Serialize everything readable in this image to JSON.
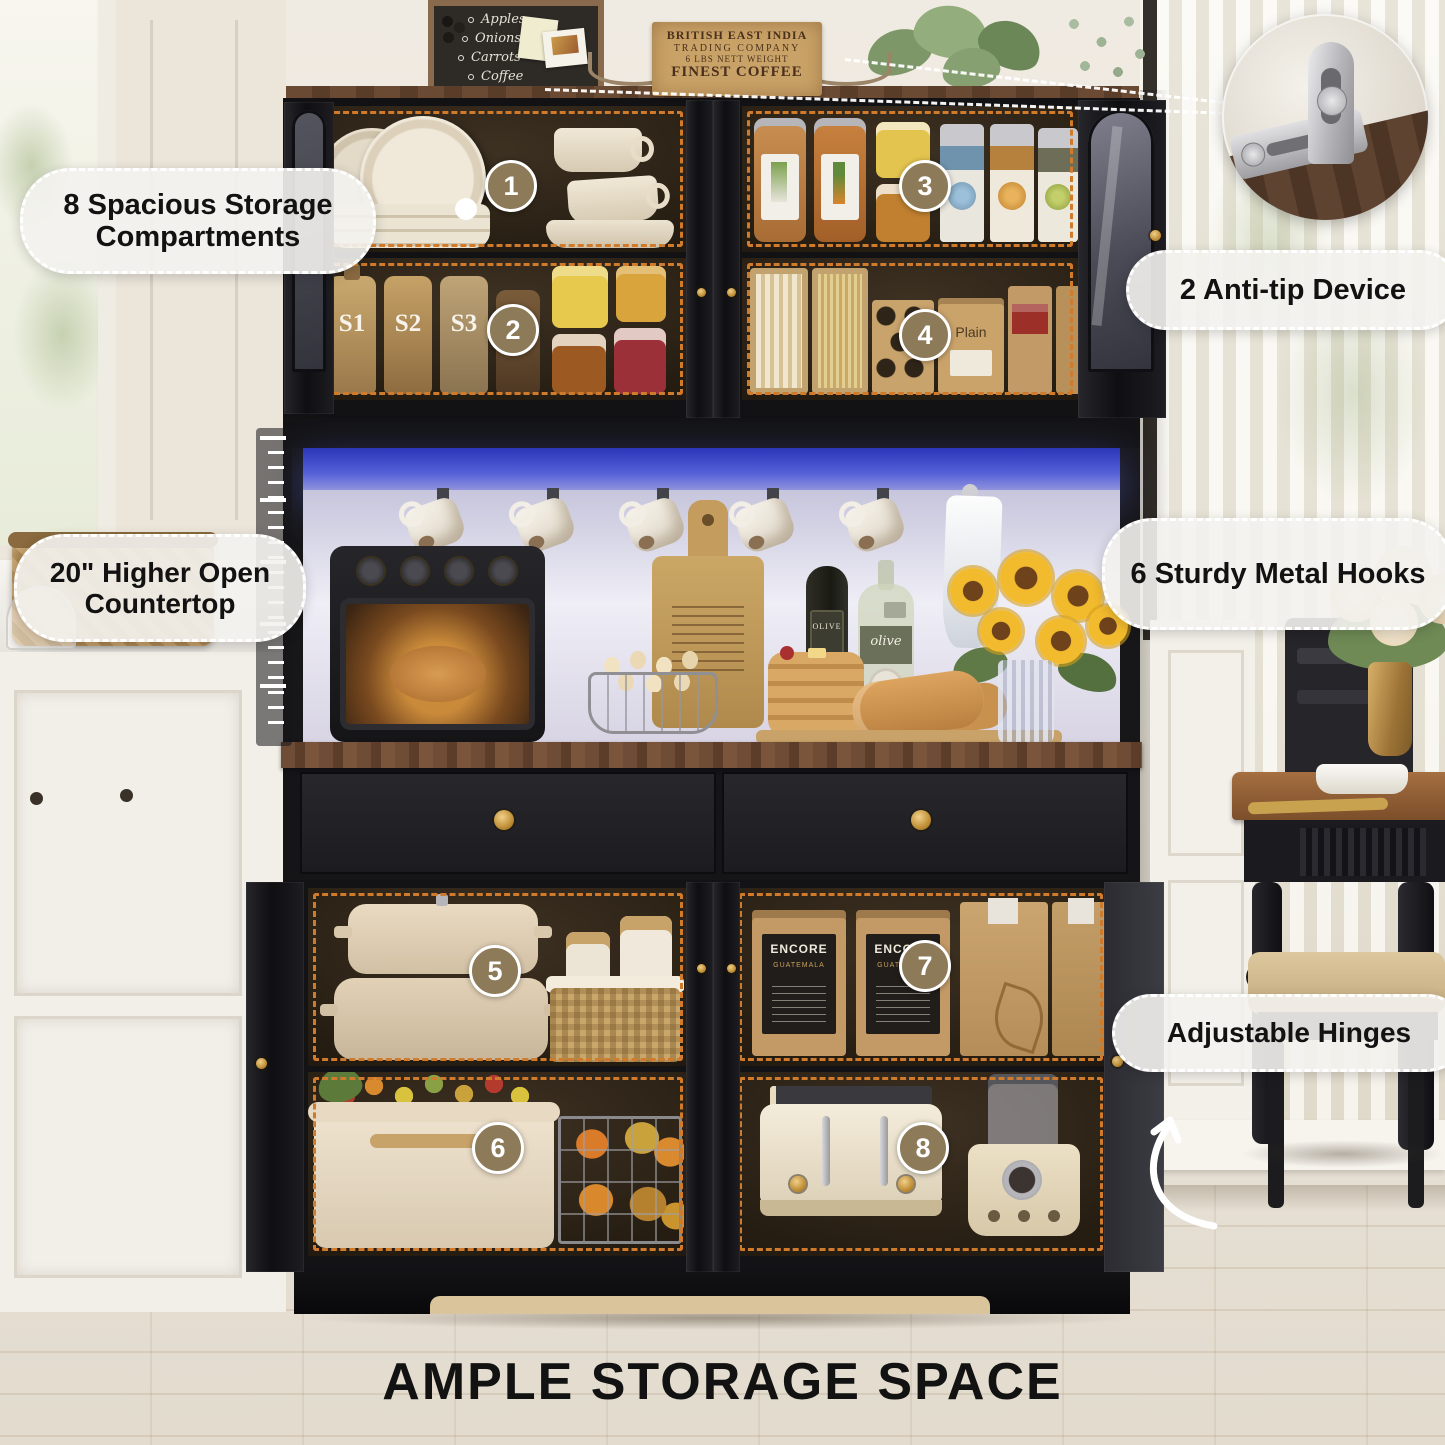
{
  "headline": "AMPLE STORAGE SPACE",
  "callouts": {
    "compartments": "8 Spacious Storage Compartments",
    "anti_tip": "2 Anti-tip Device",
    "countertop": "20\" Higher Open Countertop",
    "hooks": "6 Sturdy Metal Hooks",
    "hinges": "Adjustable Hinges"
  },
  "markers": [
    "1",
    "2",
    "3",
    "4",
    "5",
    "6",
    "7",
    "8"
  ],
  "decor": {
    "chalkboard": [
      "Apples",
      "Onions",
      "Carrots",
      "Coffee"
    ],
    "coffee_box": [
      "BRITISH EAST INDIA",
      "TRADING COMPANY",
      "6 LBS NETT WEIGHT",
      "FINEST COFFEE"
    ],
    "syrup": [
      "S1",
      "S2",
      "S3",
      "C1"
    ],
    "bag_brand": "ENCORE",
    "bag_origin": "GUATEMALA",
    "plain": "Plain",
    "olive_dark": "OLIVE",
    "olive_light": "olive"
  },
  "colors": {
    "cabinet_black": "#1b1b1e",
    "dash_orange": "#d07b2b",
    "badge_brown": "#8c7a59",
    "led_blue": "#4a55cf",
    "wood_counter": "#6b4a33",
    "gold_hardware": "#c9973f",
    "floor_wood": "#ddc69e",
    "pill_bg": "#f3f2ee"
  }
}
